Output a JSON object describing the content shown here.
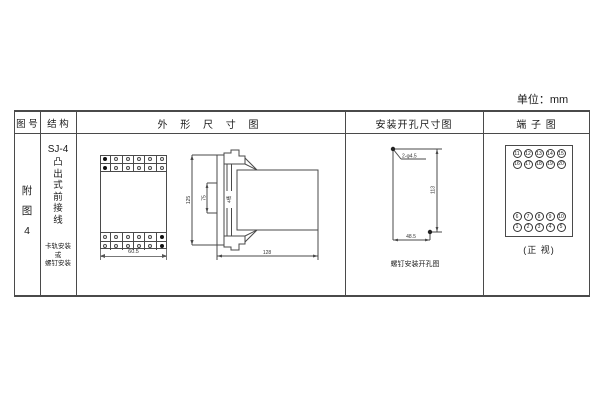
{
  "unit_label": "单位：mm",
  "colors": {
    "line": "#4a4a4a",
    "ink": "#1a1a1a"
  },
  "table": {
    "headers": {
      "col1": "图 号",
      "col2": "结 构",
      "col3": "外 形 尺 寸 图",
      "col4": "安装开孔尺寸图",
      "col5": "端 子 图"
    }
  },
  "figure_no": {
    "lines": [
      "附",
      "图",
      "4"
    ]
  },
  "structure": {
    "model": "SJ-4",
    "type_chars": [
      "凸",
      "出",
      "式",
      "前",
      "接",
      "线"
    ],
    "mount_note": [
      "卡轨安装",
      "或",
      "螺钉安装"
    ]
  },
  "outline": {
    "front": {
      "width_dim": "60.5",
      "screw_grid": {
        "cols": 6,
        "rows": 2,
        "filled_col": {
          "top": 0,
          "bottom": 5
        }
      }
    },
    "side": {
      "height_dim": "125",
      "mid_dim": "75",
      "slot_label": "4槽",
      "depth_dim": "128"
    }
  },
  "mounting": {
    "hole_label": "2-φ4.5",
    "v_dim": "113",
    "h_dim": "48.5",
    "caption": "螺钉安装开孔图"
  },
  "terminals": {
    "rows": [
      [
        "11",
        "12",
        "13",
        "14",
        "15"
      ],
      [
        "16",
        "17",
        "18",
        "19",
        "20"
      ],
      [
        "6",
        "7",
        "8",
        "9",
        "10"
      ],
      [
        "1",
        "2",
        "3",
        "4",
        "5"
      ]
    ],
    "caption": "(正 视)"
  }
}
